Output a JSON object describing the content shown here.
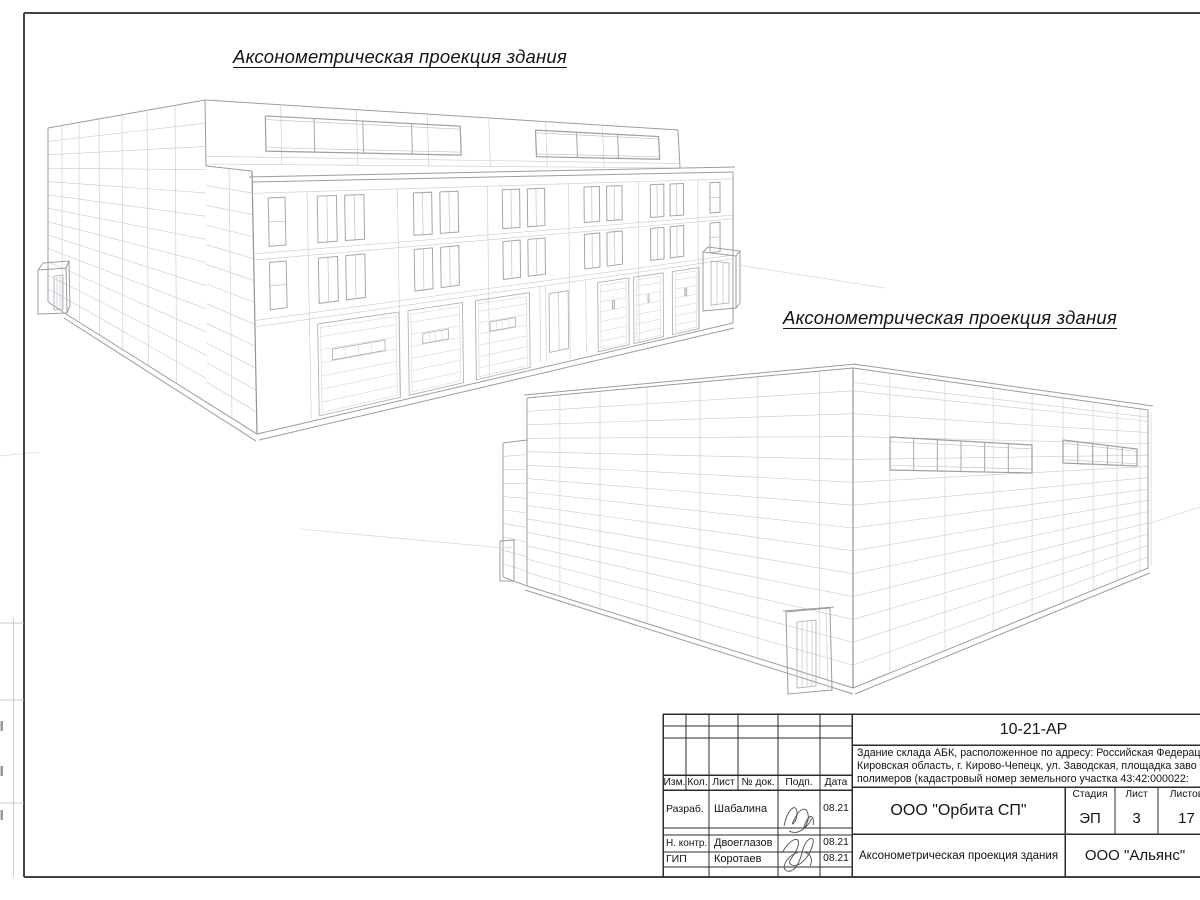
{
  "sheet": {
    "drawing1_title": "Аксонометрическая проекция здания",
    "drawing2_title": "Аксонометрическая проекция здания"
  },
  "stamp": {
    "code": "10-21-АР",
    "desc1": "Здание склада АБК, расположенное по адресу: Российская Федерац",
    "desc2": "Кировская область, г. Кирово-Чепецк, ул. Заводская, площадка заво",
    "desc3": "полимеров (кадастровый номер земельного участка 43:42:000022:",
    "col_izm": "Изм.",
    "col_kol": "Кол.",
    "col_list": "Лист",
    "col_doc": "№ док.",
    "col_podp": "Подп.",
    "col_data": "Дата",
    "role1": "Разраб.",
    "name1": "Шабалина",
    "date1": "08.21",
    "role2": "Н. контр.",
    "name2": "Двоеглазов",
    "date2": "08.21",
    "role3": "ГИП",
    "name3": "Коротаев",
    "date3": "08.21",
    "org": "ООО \"Орбита СП\"",
    "stage_label": "Стадия",
    "sheet_label": "Лист",
    "sheets_label": "Листов",
    "stage": "ЭП",
    "sheet_no": "3",
    "sheets_total": "17",
    "sheet_title": "Аксонометрическая проекция здания",
    "org2": "ООО \"Альянс\""
  }
}
